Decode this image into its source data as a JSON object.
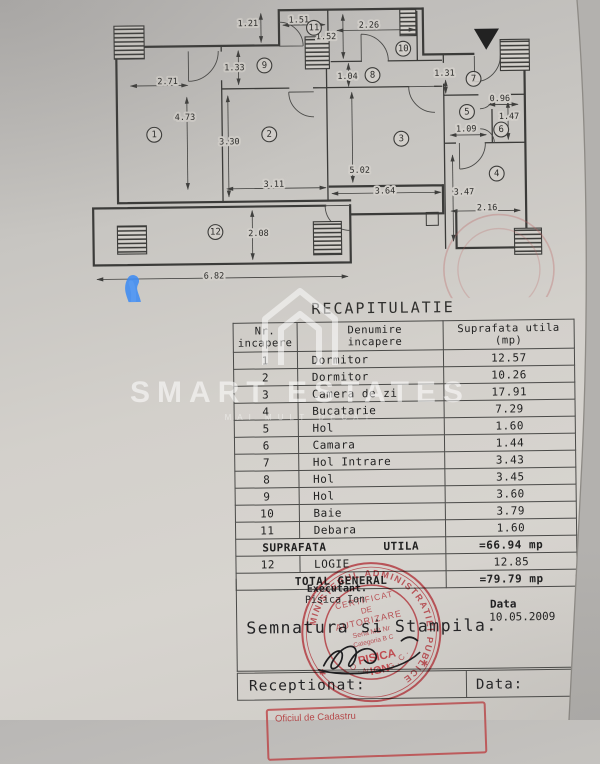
{
  "title": "RECAPITULATIE",
  "plan": {
    "rooms": [
      [
        1,
        157,
        133
      ],
      [
        2,
        272,
        134
      ],
      [
        3,
        404,
        140
      ],
      [
        4,
        499,
        176
      ],
      [
        5,
        470,
        114
      ],
      [
        6,
        504,
        132
      ],
      [
        7,
        477,
        81
      ],
      [
        8,
        376,
        76
      ],
      [
        9,
        268,
        65
      ],
      [
        10,
        407,
        50
      ],
      [
        11,
        318,
        28
      ],
      [
        12,
        217,
        231
      ]
    ],
    "dims": [
      [
        "1.21",
        252,
        23,
        265,
        13,
        265,
        42
      ],
      [
        "1.51",
        303,
        20,
        287,
        25,
        329,
        25
      ],
      [
        "2.26",
        373,
        26,
        341,
        31,
        419,
        31
      ],
      [
        "1.52",
        330,
        37,
        347,
        15,
        347,
        59
      ],
      [
        "1.33",
        238,
        67,
        242,
        50,
        242,
        84
      ],
      [
        "1.04",
        351,
        77,
        352,
        64,
        352,
        87
      ],
      [
        "2.71",
        171,
        80,
        134,
        84,
        191,
        84
      ],
      [
        "1.31",
        448,
        75,
        449,
        82,
        449,
        95
      ],
      [
        "0.96",
        503,
        101,
        492,
        107,
        521,
        107
      ],
      [
        "4.73",
        188,
        116,
        190,
        96,
        190,
        188
      ],
      [
        "3.30",
        232,
        141,
        231,
        95,
        231,
        196
      ],
      [
        "1.47",
        512,
        119,
        511,
        104,
        511,
        142
      ],
      [
        "1.09",
        469,
        131,
        453,
        137,
        489,
        137
      ],
      [
        "5.02",
        362,
        171,
        355,
        93,
        355,
        183
      ],
      [
        "3.11",
        276,
        184,
        229,
        188,
        328,
        188
      ],
      [
        "3.64",
        387,
        192,
        334,
        194,
        443,
        194
      ],
      [
        "3.47",
        466,
        194,
        455,
        157,
        455,
        243
      ],
      [
        "2.16",
        489,
        210,
        453,
        213,
        522,
        213
      ],
      [
        "2.08",
        260,
        233,
        254,
        210,
        254,
        259
      ],
      [
        "6.82",
        215,
        275,
        98,
        277,
        349,
        277
      ]
    ]
  },
  "table": {
    "header": {
      "col1a": "Nr.",
      "col1b": "incapere",
      "col2a": "Denumire",
      "col2b": "incapere",
      "col3a": "Suprafata utila",
      "col3b": "(mp)"
    },
    "rows": [
      [
        "1",
        "Dormitor",
        "12.57"
      ],
      [
        "2",
        "Dormitor",
        "10.26"
      ],
      [
        "3",
        "Camera de zi",
        "17.91"
      ],
      [
        "4",
        "Bucatarie",
        "7.29"
      ],
      [
        "5",
        "Hol",
        "1.60"
      ],
      [
        "6",
        "Camara",
        "1.44"
      ],
      [
        "7",
        "Hol Intrare",
        "3.43"
      ],
      [
        "8",
        "Hol",
        "3.45"
      ],
      [
        "9",
        "Hol",
        "3.60"
      ],
      [
        "10",
        "Baie",
        "3.79"
      ],
      [
        "11",
        "Debara",
        "1.60"
      ]
    ],
    "suprafata_label1": "SUPRAFATA",
    "suprafata_label2": "UTILA",
    "suprafata_value": "=66.94 mp",
    "logie_row": [
      "12",
      "LOGIE",
      "12.85"
    ],
    "total_label": "TOTAL GENERAL",
    "total_value": "=79.79 mp"
  },
  "footer": {
    "executant_label": "Executant.",
    "executant_name": "Pisica Ion",
    "semnatura": "Semnatura si Stampila.",
    "data_label": "Data",
    "data_value": "10.05.2009",
    "receptionat_label": "Receptionat:",
    "data2_label": "Data:"
  },
  "stamps": {
    "ring_text": "MINISTERUL ADMINISTRATIEI PUBLICE",
    "cert_line1": "CERTIFICAT",
    "cert_line2": "DE",
    "cert_line3": "AUTORIZARE",
    "seria": "Seria MB Nr",
    "categoria": "Categoria B C",
    "name_line1": "PISICA",
    "name_line2": "ION",
    "bottom_text": "O.N.C.G.C.",
    "box_text": "Oficiul de Cadastru"
  },
  "watermark": {
    "brand": "SMART ESTATES",
    "tagline": "MAI MULT DECÂT"
  },
  "colors": {
    "paper": "#d3d0cb",
    "line": "#3b3b39",
    "stamp_red": "#b5444a",
    "marker_blue": "#3e8bf2"
  }
}
